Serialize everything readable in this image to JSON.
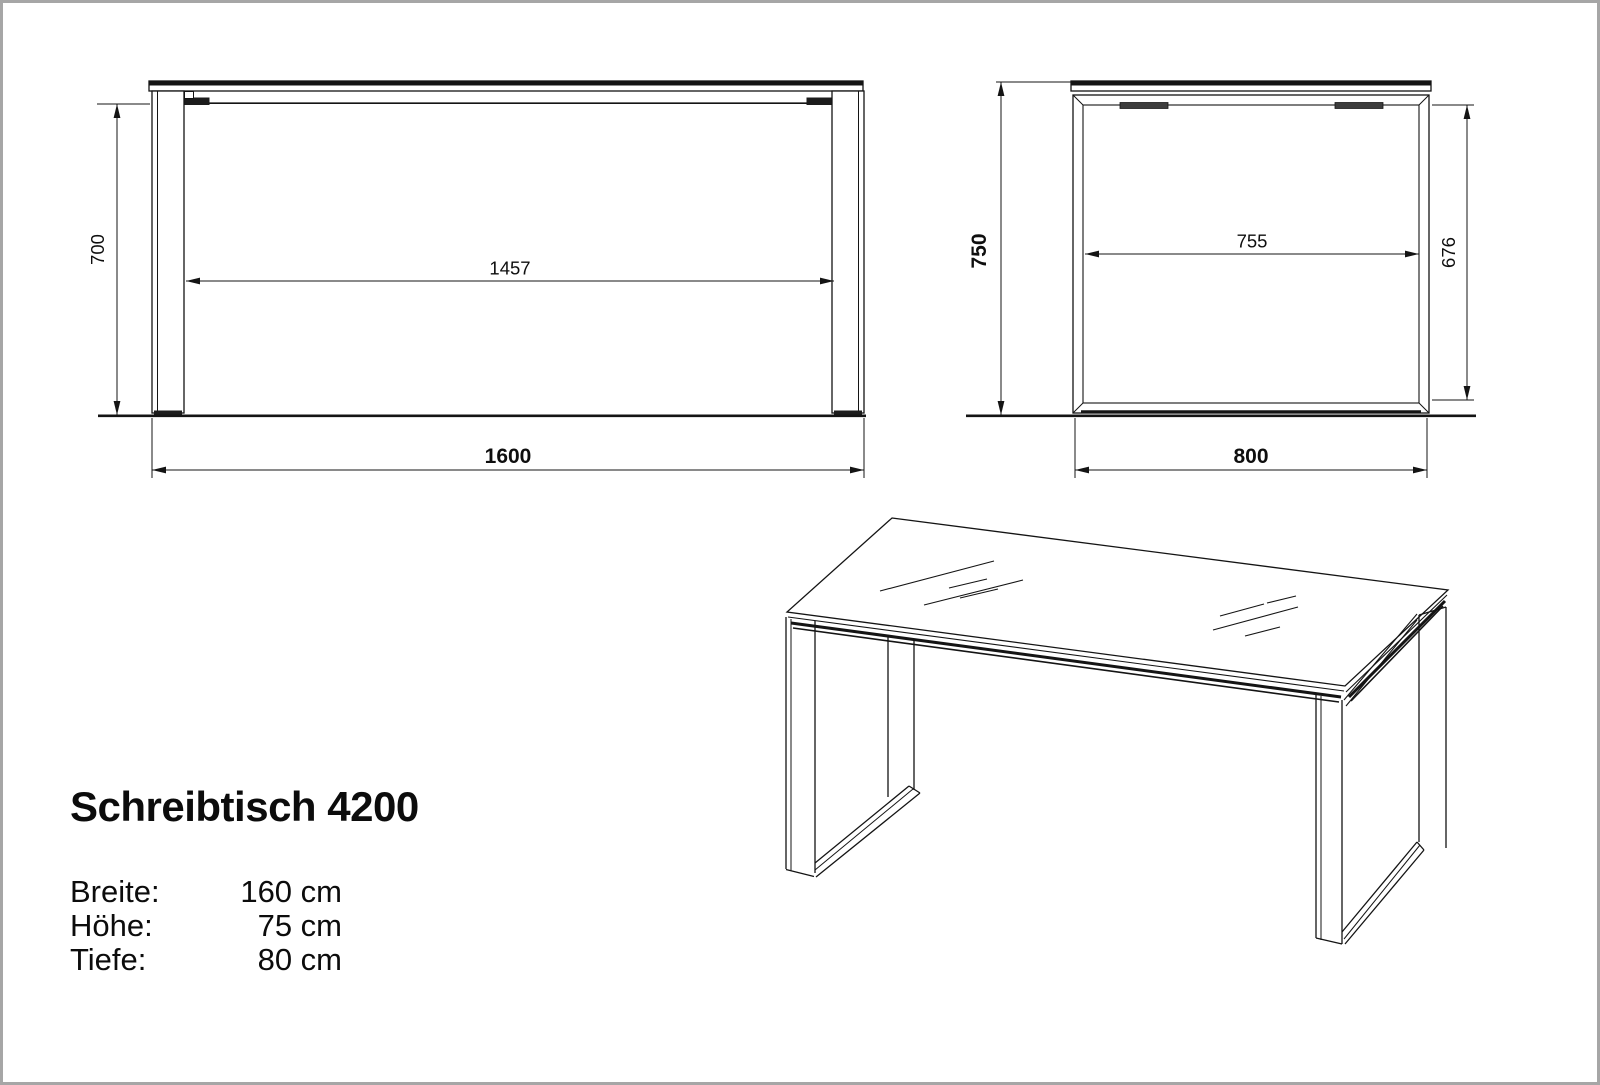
{
  "drawing": {
    "product_title": "Schreibtisch 4200",
    "specs": [
      {
        "label": "Breite:",
        "value": "160 cm"
      },
      {
        "label": "Höhe:",
        "value": "75 cm"
      },
      {
        "label": "Tiefe:",
        "value": "80 cm"
      }
    ],
    "front_view": {
      "dim_height_underside": "700",
      "dim_clear_width": "1457",
      "dim_total_width": "1600"
    },
    "side_view": {
      "dim_total_height": "750",
      "dim_clear_depth": "755",
      "dim_inner_height": "676",
      "dim_total_depth": "800"
    },
    "colors": {
      "line": "#141414",
      "background": "#ffffff",
      "page_border": "#a6a6a6"
    }
  }
}
